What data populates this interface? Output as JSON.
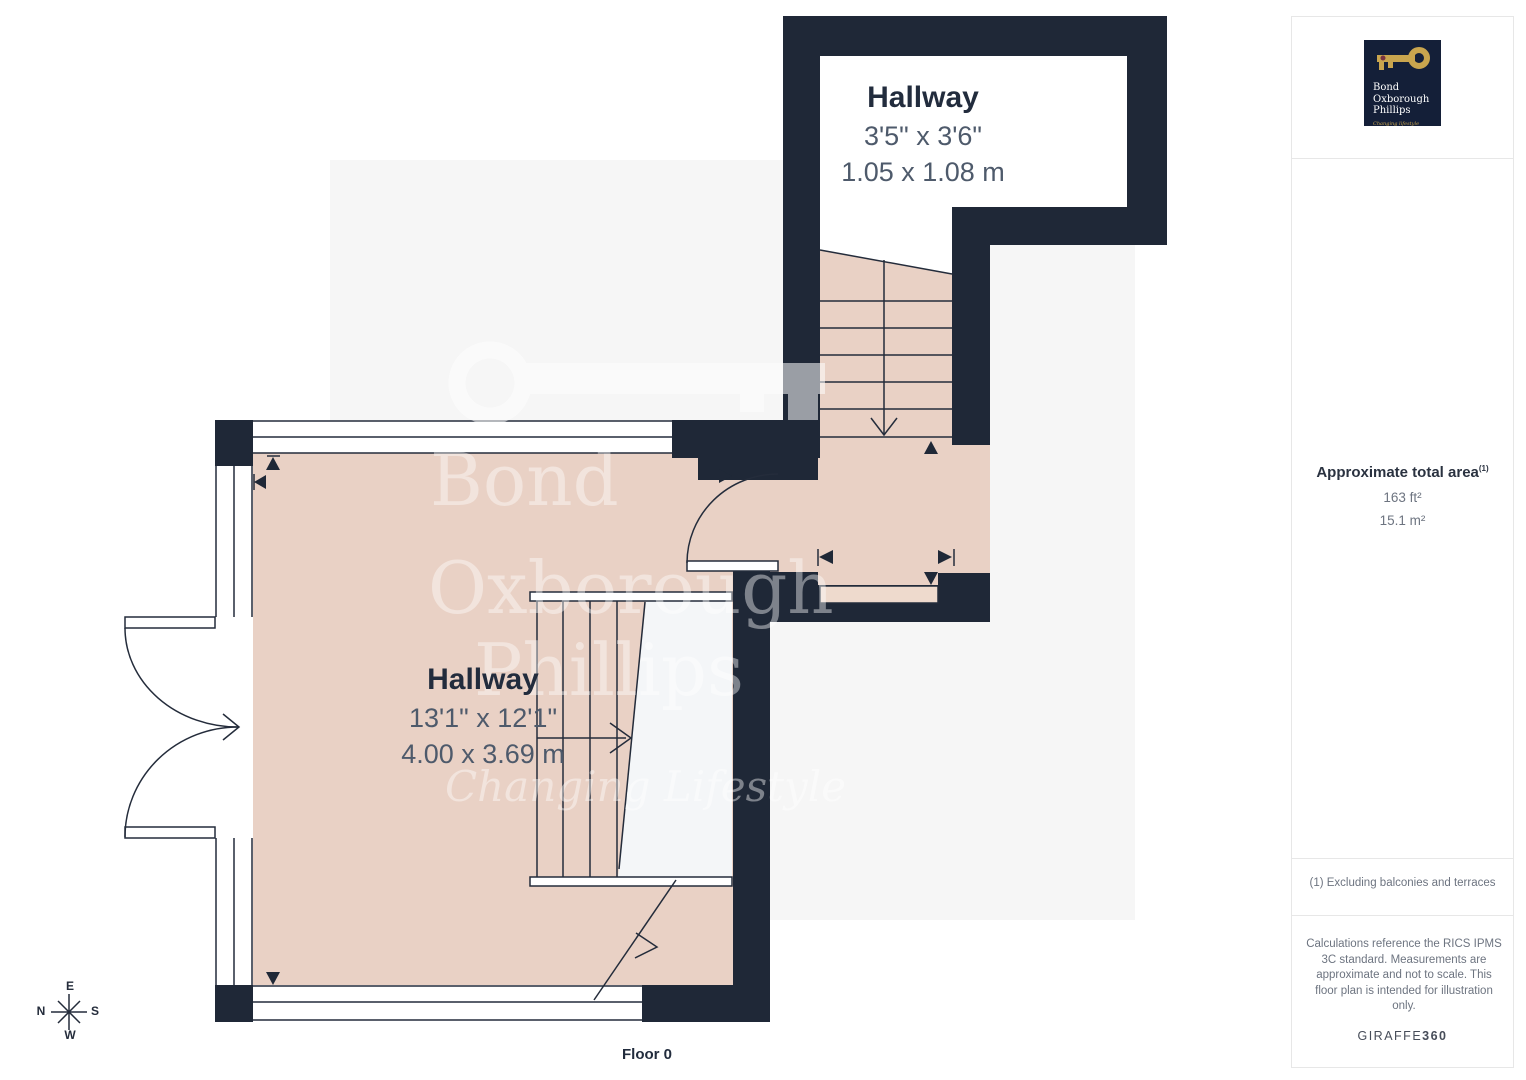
{
  "colors": {
    "wall": "#1f2837",
    "floor": "#e9d1c5",
    "floor_light": "#eedacd",
    "stair_void": "#f4f6f8",
    "plate": "#f6f6f6",
    "text_dark": "#222c3d",
    "text_gray": "#4e5a6b",
    "text_muted": "#6d7480",
    "divider": "#e7e7e7",
    "logo_bg": "#141f38",
    "gold": "#c9a54e"
  },
  "floorplan": {
    "rooms": [
      {
        "name": "Hallway",
        "imperial": "3'5\" x 3'6\"",
        "metric": "1.05 x 1.08 m"
      },
      {
        "name": "Hallway",
        "imperial": "13'1\" x 12'1\"",
        "metric": "4.00 x 3.69 m"
      }
    ],
    "floor_label": "Floor 0",
    "compass": {
      "top": "E",
      "left": "N",
      "right": "S",
      "bottom": "W"
    }
  },
  "watermark": {
    "line1": "Bond",
    "line2": "Oxborough",
    "line3": "Phillips",
    "tagline": "Changing Lifestyle"
  },
  "sidebar": {
    "logo": {
      "name_lines": [
        "Bond",
        "Oxborough",
        "Phillips"
      ],
      "tagline": "Changing lifestyle"
    },
    "area": {
      "title": "Approximate total area",
      "footnote_marker": "(1)",
      "imperial": "163 ft²",
      "metric": "15.1 m²"
    },
    "footnote": "(1) Excluding balconies and terraces",
    "disclaimer": "Calculations reference the RICS IPMS 3C standard. Measurements are approximate and not to scale. This floor plan is intended for illustration only.",
    "brand": {
      "name": "GIRAFFE",
      "suffix": "360"
    }
  }
}
